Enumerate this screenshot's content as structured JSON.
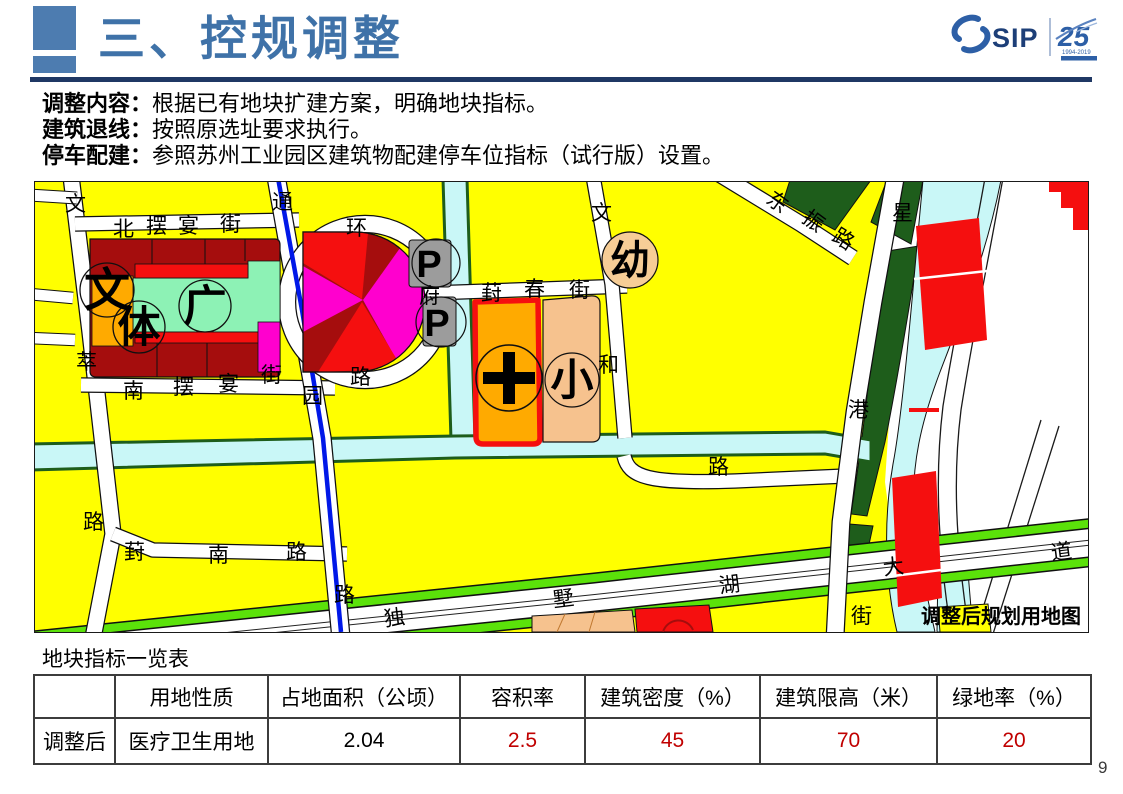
{
  "header": {
    "title": "三、控规调整"
  },
  "logo": {
    "sip": "SIP",
    "anniversary": "25",
    "years": "1994-2019"
  },
  "intro_lines": [
    {
      "label": "调整内容：",
      "text": "根据已有地块扩建方案，明确地块指标。"
    },
    {
      "label": "建筑退线：",
      "text": "按照原选址要求执行。"
    },
    {
      "label": "停车配建：",
      "text": "参照苏州工业园区建筑物配建停车位指标（试行版）设置。"
    }
  ],
  "map": {
    "caption": "调整后规划用地图",
    "labels": [
      "文",
      "北",
      "摆",
      "宴",
      "街",
      "通",
      "环",
      "葑",
      "春",
      "街",
      "文",
      "东",
      "振",
      "路",
      "星",
      "府",
      "园",
      "路",
      "萃",
      "和",
      "南",
      "摆",
      "宴",
      "街",
      "路",
      "葑",
      "南",
      "路",
      "路",
      "路",
      "港",
      "独",
      "墅",
      "湖",
      "大",
      "道",
      "街"
    ],
    "zone_symbols": {
      "culture": "文",
      "sports": "体",
      "plaza": "广",
      "school": "小",
      "kindergarten": "幼",
      "parking1": "P",
      "parking2": "P"
    },
    "colors": {
      "residential_yellow": "#ffff00",
      "dark_red": "#a50d0d",
      "red": "#f50f0f",
      "magenta": "#ff00ce",
      "hospital_orange": "#ffaa00",
      "school_peach": "#f6c28e",
      "kindergarten_tan": "#f6cd96",
      "mint_green": "#8df2b5",
      "parking_gray": "#9c9c9c",
      "water_cyan": "#c9f7f7",
      "forest_green": "#1e5d1b",
      "bright_green": "#5be20a",
      "line_blue": "#0018e8"
    }
  },
  "table": {
    "title": "地块指标一览表",
    "headers": [
      "",
      "用地性质",
      "占地面积（公顷）",
      "容积率",
      "建筑密度（%）",
      "建筑限高（米）",
      "绿地率（%）"
    ],
    "rows": [
      {
        "name": "调整后",
        "land_use": "医疗卫生用地",
        "area": "2.04",
        "far": "2.5",
        "density": "45",
        "height_limit": "70",
        "green_ratio": "20"
      }
    ]
  },
  "footer": {
    "page_number": "9"
  }
}
